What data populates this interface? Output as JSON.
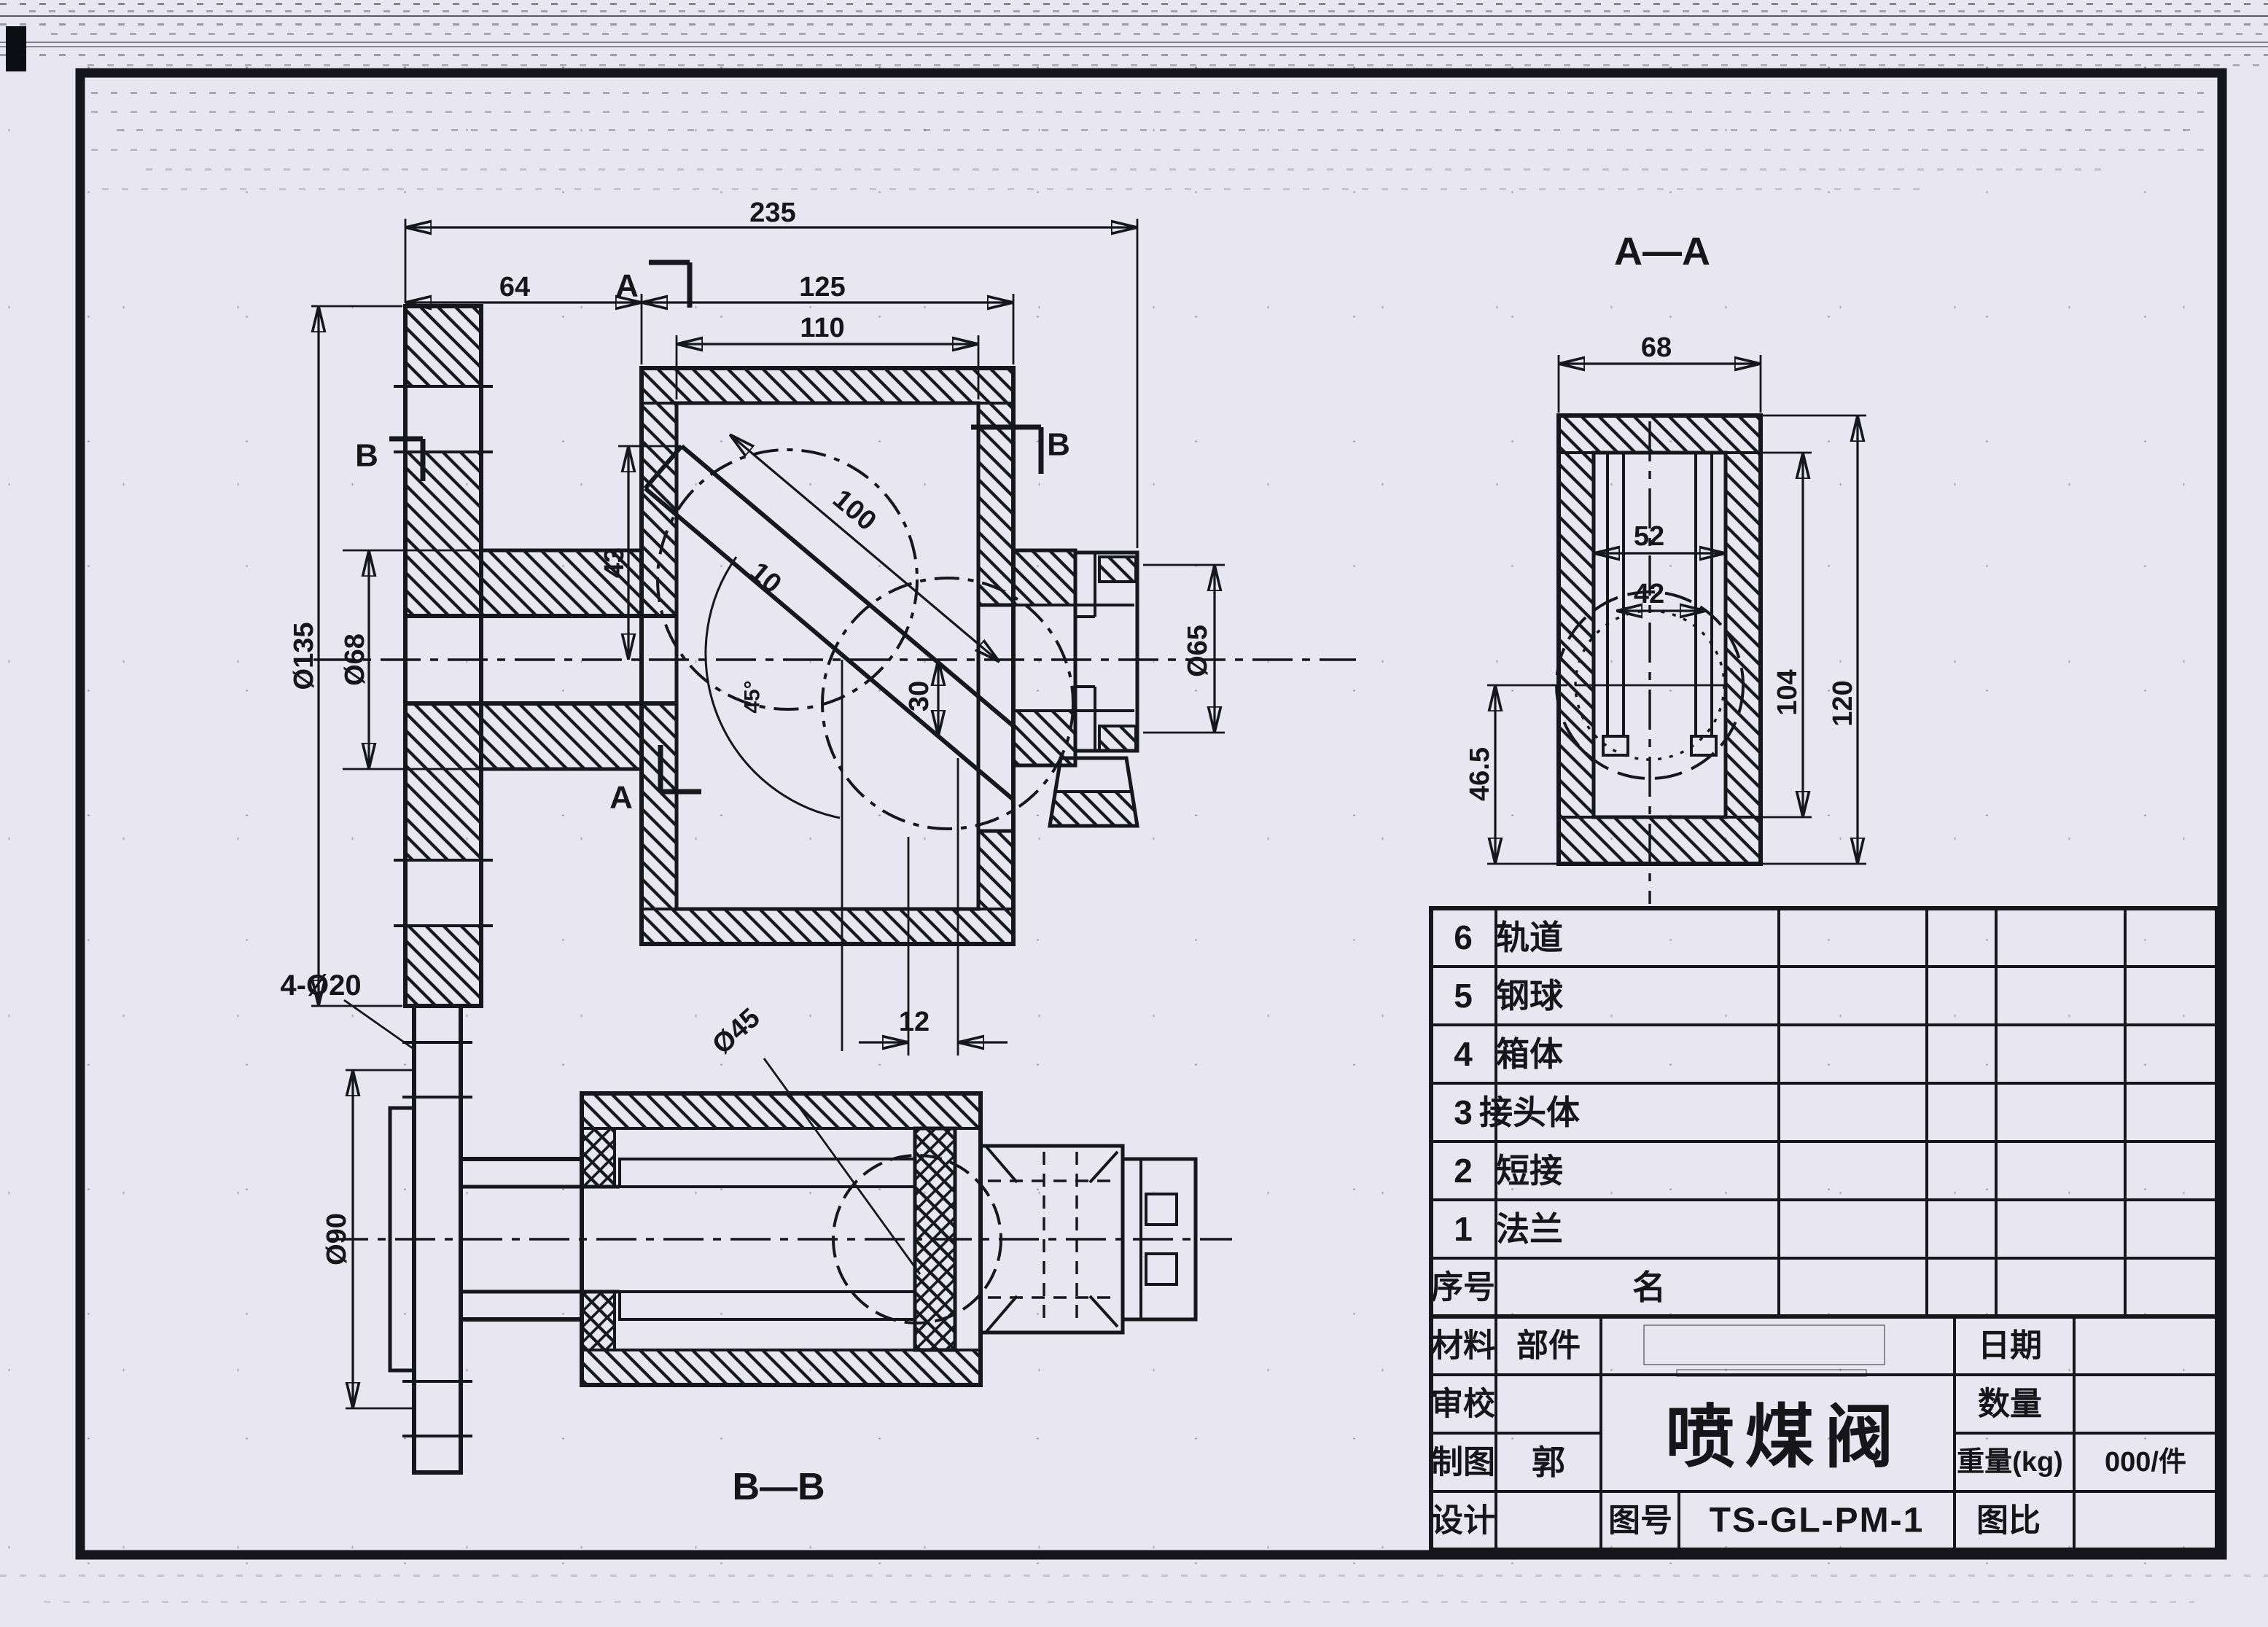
{
  "front_view": {
    "marker_a": "A",
    "marker_b": "B",
    "dim_total": "235",
    "dim_left": "64",
    "dim_box": "125",
    "dim_inner": "110",
    "dim_flange_od": "Ø135",
    "dim_neck_od": "Ø68",
    "dim_slot_len": "100",
    "dim_slot_w": "10",
    "dim_43": "43",
    "dim_30": "30",
    "dim_12": "12",
    "dim_angle": "45°",
    "dim_right_od": "Ø65"
  },
  "section_aa": {
    "label": "A—A",
    "dim_68": "68",
    "dim_52": "52",
    "dim_42": "42",
    "dim_104": "104",
    "dim_120": "120",
    "dim_465": "46.5"
  },
  "section_bb": {
    "label": "B—B",
    "dim_bolts": "4-Ø20",
    "dim_90": "Ø90",
    "dim_45": "Ø45"
  },
  "parts_list": {
    "header": {
      "no": "序号",
      "name": "名"
    },
    "rows": [
      {
        "no": "6",
        "name": "轨道"
      },
      {
        "no": "5",
        "name": "钢球"
      },
      {
        "no": "4",
        "name": "箱体"
      },
      {
        "no": "3",
        "name": "接头体"
      },
      {
        "no": "2",
        "name": "短接"
      },
      {
        "no": "1",
        "name": "法兰"
      }
    ]
  },
  "title_block": {
    "material": "材料",
    "part": "部件",
    "review": "审校",
    "draft": "制图",
    "draft_by": "郭",
    "design": "设计",
    "product_title": "喷煤阀",
    "drawing_no_label": "图号",
    "drawing_no": "TS-GL-PM-1",
    "date": "日期",
    "quantity": "数量",
    "weight": "重量(kg)",
    "weight_value": "000/件",
    "scale": "图比"
  }
}
